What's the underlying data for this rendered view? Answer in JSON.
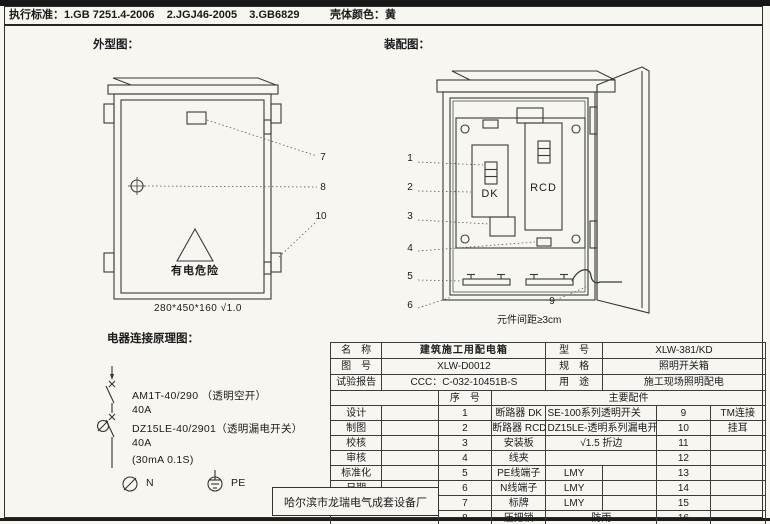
{
  "sheet": {
    "standards_label": "执行标准：",
    "standards": "1.GB 7251.4-2006    2.JGJ46-2005    3.GB6829",
    "shell_label": "壳体颜色：",
    "shell_value": "黄"
  },
  "outline": {
    "title": "外型图：",
    "warning": "有电危险",
    "dimensions": "280*450*160  √1.0",
    "callouts": [
      "7",
      "8",
      "10"
    ]
  },
  "assembly": {
    "title": "装配图：",
    "dk": "DK",
    "rcd": "RCD",
    "spacing_note": "元件间距≥3cm",
    "callouts": [
      "1",
      "2",
      "3",
      "4",
      "5",
      "6"
    ],
    "callout_9": "9"
  },
  "schematic": {
    "title": "电器连接原理图：",
    "lines": [
      "AM1T-40/290 （透明空开）",
      "40A",
      "DZ15LE-40/2901（透明漏电开关）",
      "40A",
      "(30mA 0.1S)"
    ],
    "n": "N",
    "pe": "PE"
  },
  "titleblock": {
    "info": [
      {
        "l1": "名　称",
        "v1": "建筑施工用配电箱",
        "l2": "型　号",
        "v2": "XLW-381/KD"
      },
      {
        "l1": "图　号",
        "v1": "XLW-D0012",
        "l2": "规　格",
        "v2": "照明开关箱"
      },
      {
        "l1": "试验报告",
        "v1": "CCC：C-032-10451B-S",
        "l2": "用　途",
        "v2": "施工现场照明配电"
      }
    ],
    "seq_header": "序　号",
    "parts_header": "主要配件",
    "rows": [
      {
        "sig": "设计",
        "no": "1",
        "name": "断路器 DK",
        "spec": "SE-100系列透明开关",
        "no2": "9",
        "val": "TM连接"
      },
      {
        "sig": "制图",
        "no": "2",
        "name": "断路器 RCD",
        "spec": "DZ15LE-透明系列漏电开",
        "no2": "10",
        "val": "挂耳"
      },
      {
        "sig": "校核",
        "no": "3",
        "name": "安装板",
        "spec": "√1.5 折边",
        "no2": "11",
        "val": ""
      },
      {
        "sig": "审核",
        "no": "4",
        "name": "线夹",
        "spec": "",
        "no2": "12",
        "val": ""
      },
      {
        "sig": "标准化",
        "no": "5",
        "name": "PE线端子",
        "spec": "LMY",
        "no2": "13",
        "val": ""
      },
      {
        "sig": "日期",
        "no": "6",
        "name": "N线端子",
        "spec": "LMY",
        "no2": "14",
        "val": ""
      },
      {
        "sig": "",
        "no": "7",
        "name": "标牌",
        "spec": "LMY",
        "no2": "15",
        "val": ""
      },
      {
        "sig": "",
        "no": "8",
        "name": "压把锁",
        "spec": "防雨",
        "no2": "16",
        "val": ""
      }
    ],
    "factory": "哈尔滨市龙瑞电气成套设备厂"
  }
}
